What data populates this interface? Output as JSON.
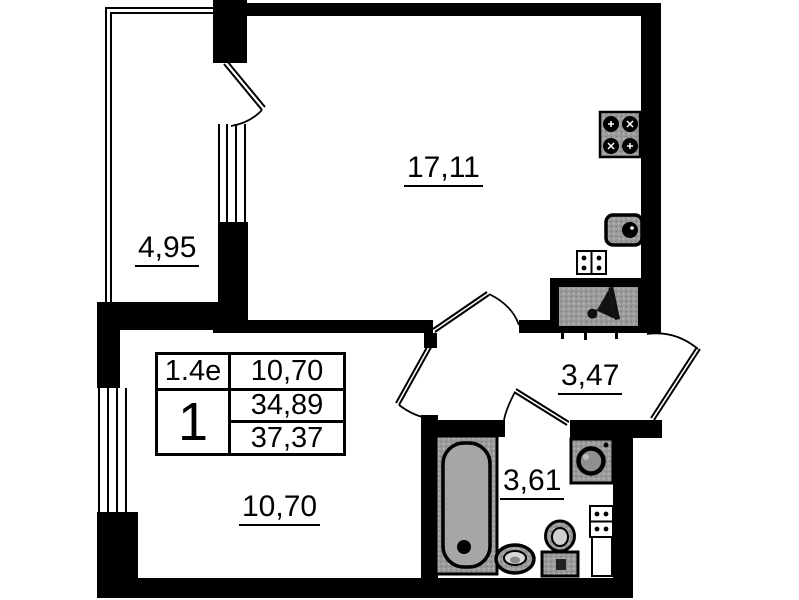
{
  "floor_plan": {
    "type": "apartment-floor-plan",
    "rooms": {
      "living_room": {
        "area": "17,11"
      },
      "balcony": {
        "area": "4,95"
      },
      "hallway": {
        "area": "3,47"
      },
      "bedroom": {
        "area": "10,70"
      },
      "bathroom": {
        "area": "3,61"
      }
    },
    "info_table": {
      "plan_code": "1.4e",
      "room_count": "1",
      "living_area": "10,70",
      "area_without_balcony": "34,89",
      "total_area": "37,37"
    },
    "fixtures": [
      "stove",
      "kitchen-sink",
      "electric-meter-box",
      "ventilation-shaft",
      "bathtub",
      "washbasin",
      "toilet",
      "washing-machine",
      "utility-meter-box"
    ],
    "colors": {
      "walls": "#000000",
      "fixture_fill": "#9b9b9b",
      "background": "#ffffff"
    }
  }
}
